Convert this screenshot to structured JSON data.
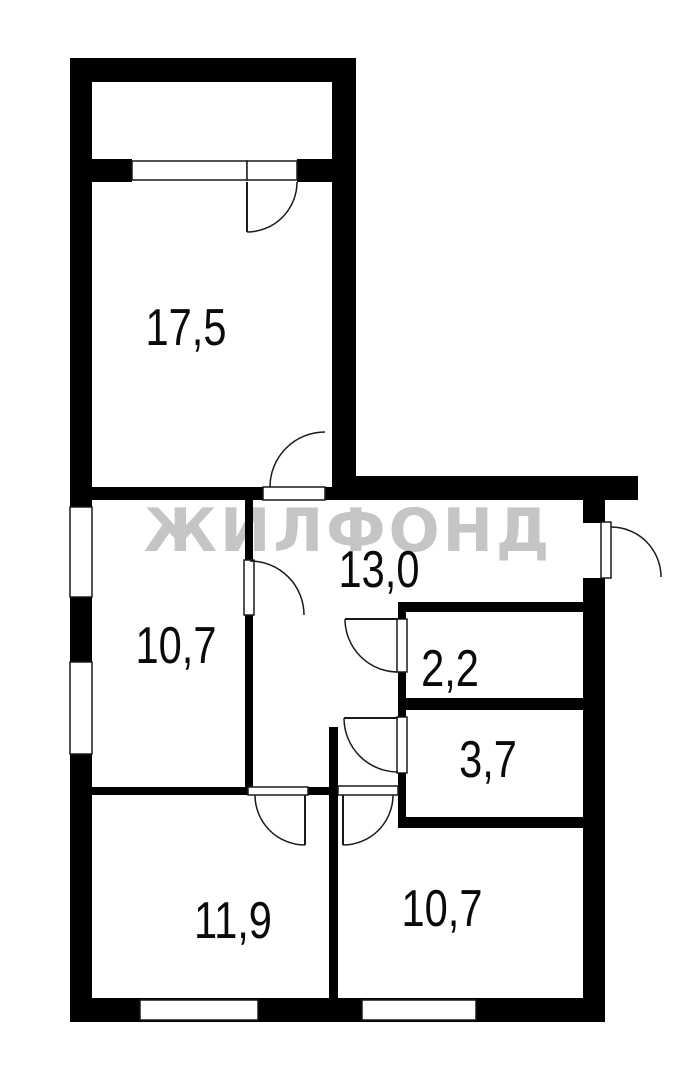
{
  "title": "Floor plan with ZHILFOND watermark",
  "watermark": {
    "text": "ЖИЛФОНД",
    "color": "#c5c5c5",
    "x": 348,
    "y": 531
  },
  "plan": {
    "canvas": {
      "w": 693,
      "h": 1080,
      "bg": "#ffffff",
      "wall_color": "#000000",
      "line_color": "#1a1a1a"
    },
    "rooms": [
      {
        "name": "room-17-5",
        "label": "17,5",
        "x": 186,
        "y": 328
      },
      {
        "name": "hall-13-0",
        "label": "13,0",
        "x": 379,
        "y": 570
      },
      {
        "name": "room-10-7-left",
        "label": "10,7",
        "x": 176,
        "y": 646
      },
      {
        "name": "room-2-2",
        "label": "2,2",
        "x": 450,
        "y": 669
      },
      {
        "name": "room-3-7",
        "label": "3,7",
        "x": 488,
        "y": 760
      },
      {
        "name": "room-11-9",
        "label": "11,9",
        "x": 233,
        "y": 921
      },
      {
        "name": "room-10-7-right",
        "label": "10,7",
        "x": 442,
        "y": 909
      }
    ],
    "walls": [
      {
        "name": "outer-wall-left",
        "x": 70,
        "y": 58,
        "w": 22,
        "h": 964
      },
      {
        "name": "outer-wall-top-balcony",
        "x": 70,
        "y": 58,
        "w": 286,
        "h": 24
      },
      {
        "name": "outer-wall-right-17-5",
        "x": 332,
        "y": 58,
        "w": 24,
        "h": 442
      },
      {
        "name": "outer-wall-hall-top",
        "x": 332,
        "y": 476,
        "w": 306,
        "h": 24
      },
      {
        "name": "outer-wall-right-upper",
        "x": 583,
        "y": 500,
        "w": 22,
        "h": 23
      },
      {
        "name": "outer-wall-right-lower",
        "x": 583,
        "y": 578,
        "w": 22,
        "h": 444
      },
      {
        "name": "outer-wall-bottom",
        "x": 70,
        "y": 998,
        "w": 535,
        "h": 24
      },
      {
        "name": "balcony-front-wall-left",
        "x": 70,
        "y": 159,
        "w": 62,
        "h": 23
      },
      {
        "name": "balcony-front-wall-right",
        "x": 297,
        "y": 159,
        "w": 59,
        "h": 23
      },
      {
        "name": "wall-17-5-bottom-left",
        "x": 92,
        "y": 487,
        "w": 171,
        "h": 13
      },
      {
        "name": "wall-17-5-bottom-right",
        "x": 325,
        "y": 487,
        "w": 7,
        "h": 13
      },
      {
        "name": "wall-10-7-left-upper",
        "x": 245,
        "y": 500,
        "w": 8,
        "h": 60
      },
      {
        "name": "wall-10-7-left-lower",
        "x": 245,
        "y": 615,
        "w": 8,
        "h": 180
      },
      {
        "name": "wall-2-2-top",
        "x": 398,
        "y": 602,
        "w": 185,
        "h": 10
      },
      {
        "name": "wall-hall-2-2-a",
        "x": 398,
        "y": 612,
        "w": 8,
        "h": 7
      },
      {
        "name": "wall-hall-2-2-b",
        "x": 398,
        "y": 672,
        "w": 8,
        "h": 45
      },
      {
        "name": "wall-hall-3-7-c",
        "x": 398,
        "y": 773,
        "w": 8,
        "h": 55
      },
      {
        "name": "wall-2-2-3-7-divider",
        "x": 406,
        "y": 698,
        "w": 177,
        "h": 12
      },
      {
        "name": "wall-3-7-bottom",
        "x": 398,
        "y": 817,
        "w": 185,
        "h": 11
      },
      {
        "name": "wall-11-9-top-left",
        "x": 92,
        "y": 787,
        "w": 156,
        "h": 8
      },
      {
        "name": "wall-11-9-top-right",
        "x": 308,
        "y": 787,
        "w": 21,
        "h": 8
      },
      {
        "name": "wall-11-9-10-7-divider",
        "x": 329,
        "y": 727,
        "w": 9,
        "h": 295
      }
    ],
    "windows": [
      {
        "name": "window-10-7-left-upper",
        "x": 70,
        "y": 507,
        "w": 22,
        "h": 90
      },
      {
        "name": "window-10-7-left-lower",
        "x": 70,
        "y": 662,
        "w": 22,
        "h": 92
      },
      {
        "name": "window-11-9-bottom",
        "x": 140,
        "y": 1000,
        "w": 118,
        "h": 20
      },
      {
        "name": "window-10-7-right-bottom",
        "x": 362,
        "y": 1000,
        "w": 114,
        "h": 20
      },
      {
        "name": "window-balcony",
        "x": 132,
        "y": 161,
        "w": 115,
        "h": 19
      }
    ],
    "sills": [
      {
        "name": "sill-balcony-door",
        "x": 247,
        "y": 161,
        "w": 50,
        "h": 19
      },
      {
        "name": "sill-17-5-door",
        "x": 263,
        "y": 487,
        "w": 62,
        "h": 13
      },
      {
        "name": "sill-10-7-left-door",
        "x": 244,
        "y": 560,
        "w": 10,
        "h": 55
      },
      {
        "name": "sill-entrance-door",
        "x": 601,
        "y": 522,
        "w": 10,
        "h": 56
      },
      {
        "name": "sill-2-2-door",
        "x": 397,
        "y": 619,
        "w": 10,
        "h": 53
      },
      {
        "name": "sill-3-7-door",
        "x": 397,
        "y": 717,
        "w": 10,
        "h": 56
      },
      {
        "name": "sill-11-9-door",
        "x": 248,
        "y": 787,
        "w": 60,
        "h": 8
      },
      {
        "name": "sill-10-7-right-door",
        "x": 338,
        "y": 786,
        "w": 60,
        "h": 9
      }
    ],
    "doors": [
      {
        "name": "balcony-door",
        "hinge": [
          247,
          182
        ],
        "r": 50,
        "from": 90,
        "to": 0,
        "sweep": 0,
        "leaf": 90
      },
      {
        "name": "door-17-5",
        "hinge": [
          325,
          487
        ],
        "r": 55,
        "from": 180,
        "to": 270,
        "sweep": 1
      },
      {
        "name": "door-10-7-left",
        "hinge": [
          250,
          615
        ],
        "r": 54,
        "from": 270,
        "to": 360,
        "sweep": 1
      },
      {
        "name": "entrance-door",
        "hinge": [
          611,
          577
        ],
        "r": 50,
        "from": 270,
        "to": 360,
        "sweep": 1
      },
      {
        "name": "door-2-2",
        "hinge": [
          398,
          619
        ],
        "r": 53,
        "from": 180,
        "to": 90,
        "sweep": 0,
        "leaf": 180
      },
      {
        "name": "door-3-7",
        "hinge": [
          398,
          718
        ],
        "r": 54,
        "from": 180,
        "to": 90,
        "sweep": 0,
        "leaf": 180
      },
      {
        "name": "door-11-9",
        "hinge": [
          305,
          795
        ],
        "r": 50,
        "from": 90,
        "to": 180,
        "sweep": 1,
        "leaf": 90
      },
      {
        "name": "door-10-7-right",
        "hinge": [
          343,
          795
        ],
        "r": 50,
        "from": 90,
        "to": 0,
        "sweep": 0,
        "leaf": 90
      }
    ]
  }
}
